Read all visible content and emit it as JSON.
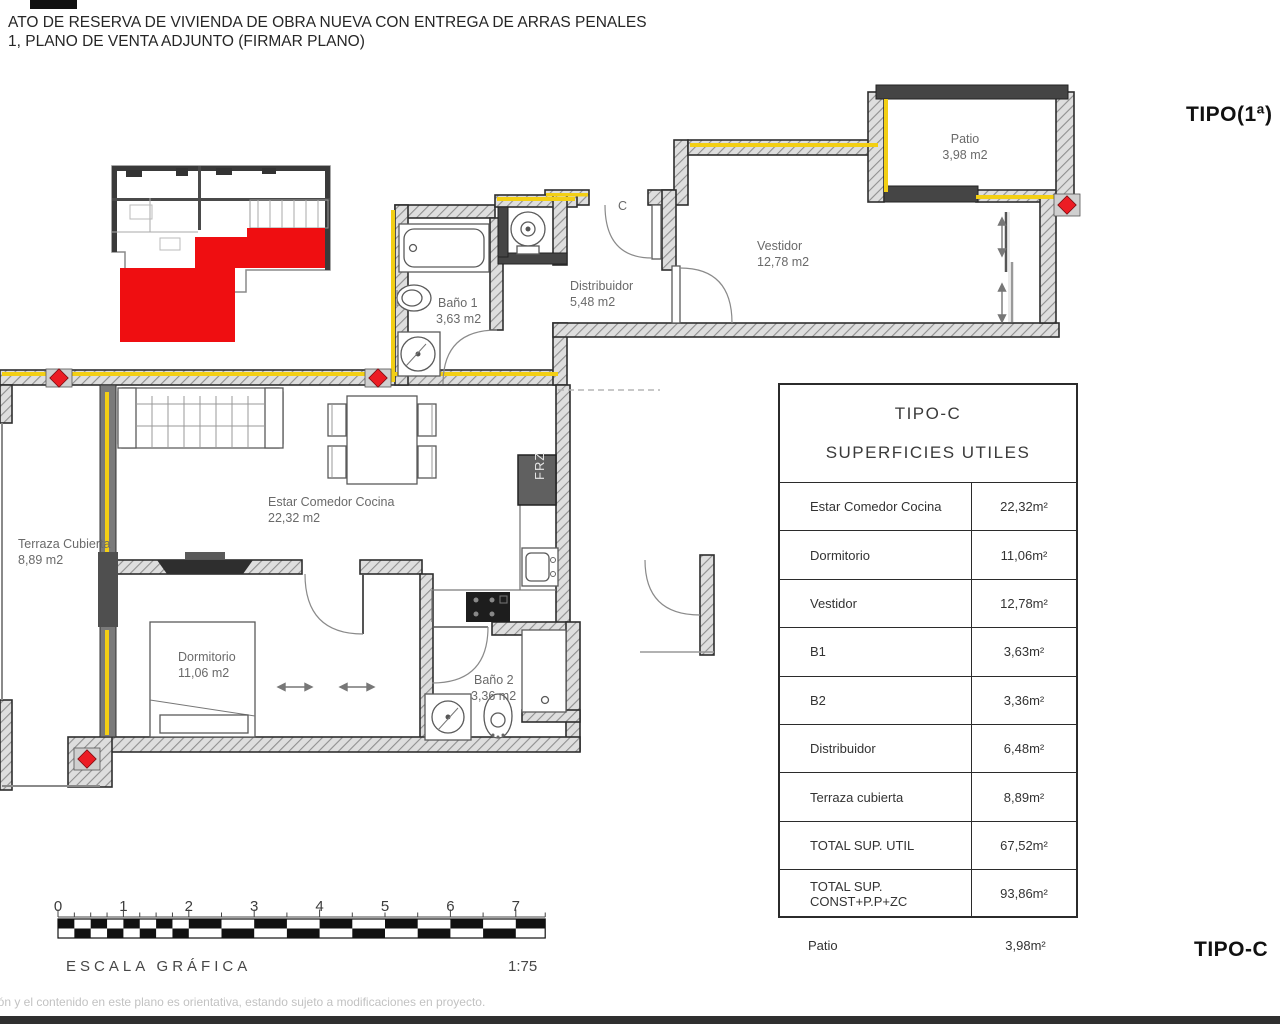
{
  "header": {
    "line1": "ATO DE RESERVA DE VIVIENDA DE OBRA NUEVA CON ENTREGA DE ARRAS PENALES",
    "line2": "1, PLANO DE VENTA ADJUNTO (FIRMAR PLANO)"
  },
  "corner_labels": {
    "top_right": "TIPO(1ª)",
    "bottom_right": "TIPO-C"
  },
  "plan": {
    "rooms": [
      {
        "name": "Patio",
        "area": "3,98 m2"
      },
      {
        "name": "Vestidor",
        "area": "12,78 m2"
      },
      {
        "name": "Distribuidor",
        "area": "5,48 m2"
      },
      {
        "name": "Baño 1",
        "area": "3,63 m2"
      },
      {
        "name": "Estar Comedor Cocina",
        "area": "22,32 m2"
      },
      {
        "name": "Terraza Cubierta",
        "area": "8,89 m2"
      },
      {
        "name": "Dormitorio",
        "area": "11,06 m2"
      },
      {
        "name": "Baño 2",
        "area": "3,36 m2"
      }
    ],
    "annotations": {
      "entry_label": "C",
      "fridge_label": "FRZ"
    }
  },
  "table": {
    "title": "TIPO-C",
    "subtitle": "SUPERFICIES UTILES",
    "rows": [
      {
        "label": "Estar Comedor Cocina",
        "value": "22,32m²"
      },
      {
        "label": "Dormitorio",
        "value": "11,06m²"
      },
      {
        "label": "Vestidor",
        "value": "12,78m²"
      },
      {
        "label": "B1",
        "value": "3,63m²"
      },
      {
        "label": "B2",
        "value": "3,36m²"
      },
      {
        "label": "Distribuidor",
        "value": "6,48m²"
      },
      {
        "label": "Terraza cubierta",
        "value": "8,89m²"
      },
      {
        "label": "TOTAL SUP. UTIL",
        "value": "67,52m²"
      },
      {
        "label": "TOTAL SUP. CONST+P.P+ZC",
        "value": "93,86m²"
      }
    ],
    "footer_row": {
      "label": "Patio",
      "value": "3,98m²"
    }
  },
  "scale_bar": {
    "ticks": [
      "0",
      "1",
      "2",
      "3",
      "4",
      "5",
      "6",
      "7"
    ],
    "caption": "ESCALA GRÁFICA",
    "ratio": "1:75"
  },
  "disclaimer": "ión y el contenido en este plano es orientativa, estando sujeto a modificaciones en proyecto.",
  "colors": {
    "wall": "#3f3f3f",
    "accent_yellow": "#f3cf14",
    "marker_red": "#ec1c24",
    "room_text": "#6a6a6a"
  }
}
